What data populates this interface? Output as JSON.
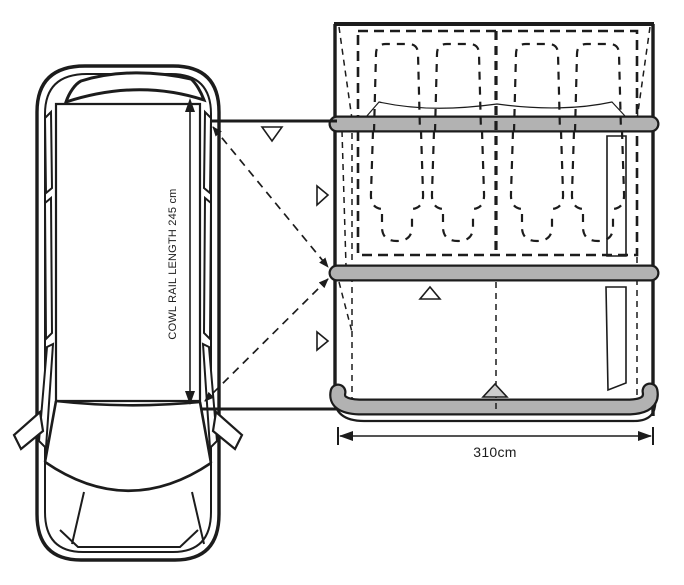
{
  "labels": {
    "cowl_rail_length": "COWL RAIL LENGTH 245 cm",
    "awning_width": "310cm"
  },
  "colors": {
    "line": "#1c1c1c",
    "beam_gray": "#b2b2b2",
    "marker_gray": "#cccccc",
    "background": "#ffffff"
  }
}
